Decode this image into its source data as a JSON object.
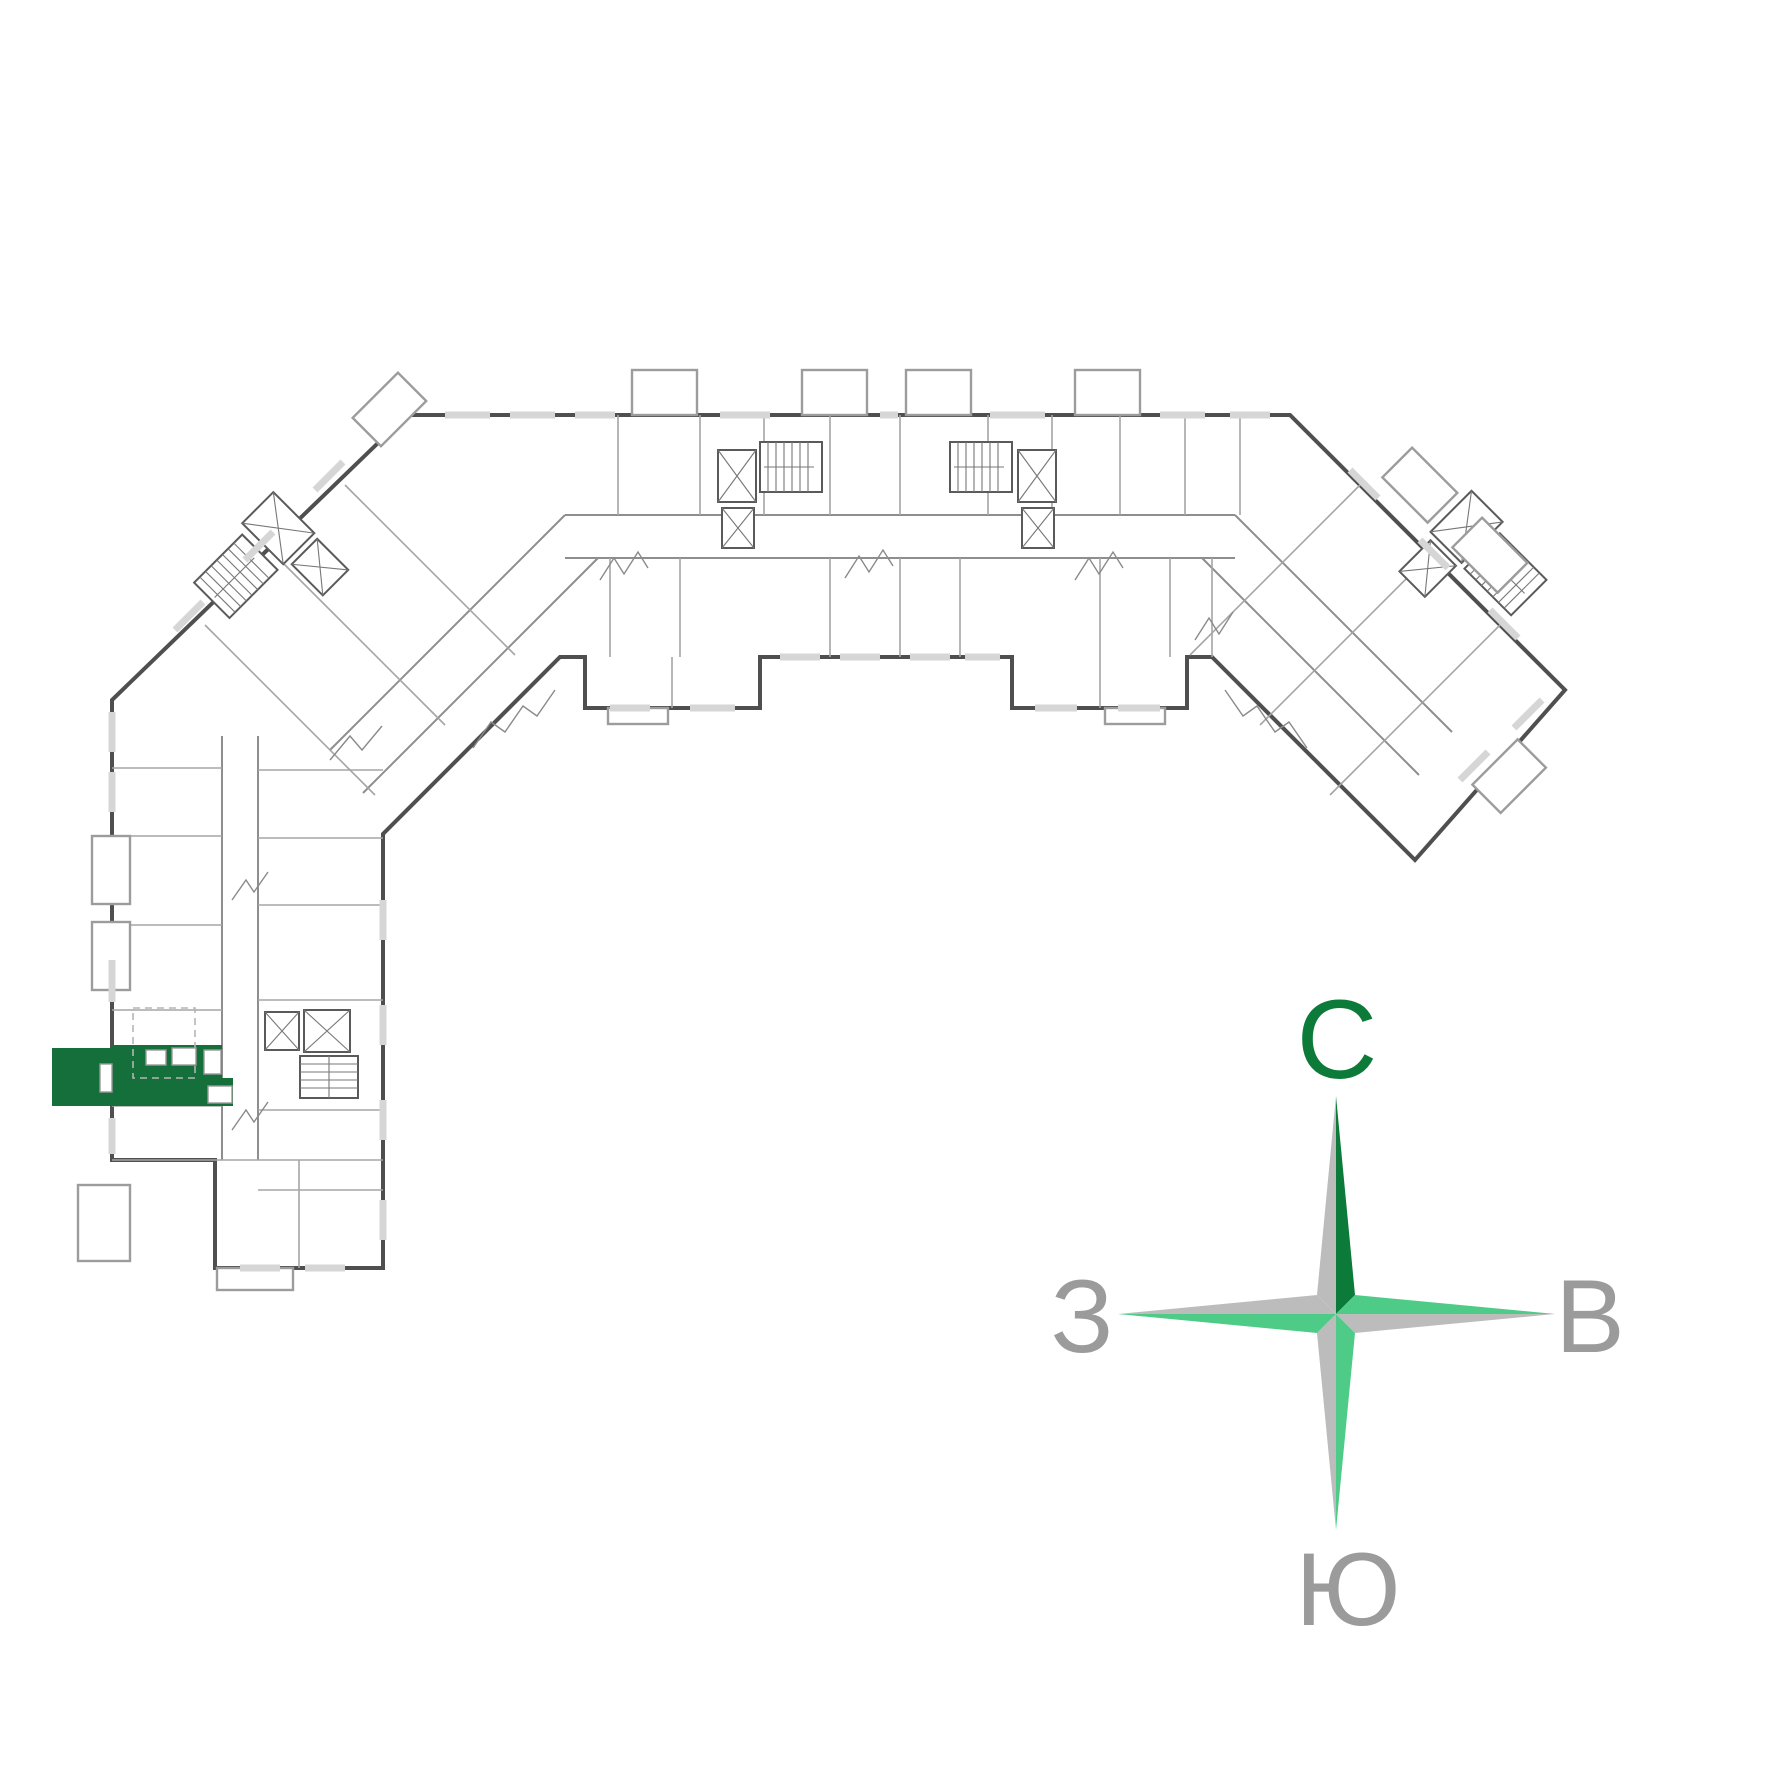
{
  "page": {
    "background": "#ffffff",
    "type": "building-floor-plan"
  },
  "plan": {
    "highlight_color": "#156f3b",
    "wall_color": "#4f4f4f",
    "partition_color": "#a5a5a5",
    "window_color": "#d6d6d6",
    "balcony_color": "#9c9c9c",
    "highlighted_unit": {
      "label": "selected-apartment"
    }
  },
  "compass": {
    "labels": {
      "north": "С",
      "east": "В",
      "south": "Ю",
      "west": "З"
    },
    "colors": {
      "dark_green": "#0c7a38",
      "mint": "#4ecb87",
      "arm_gray": "#bcbcbc",
      "letter_gray": "#9b9b9b"
    }
  }
}
